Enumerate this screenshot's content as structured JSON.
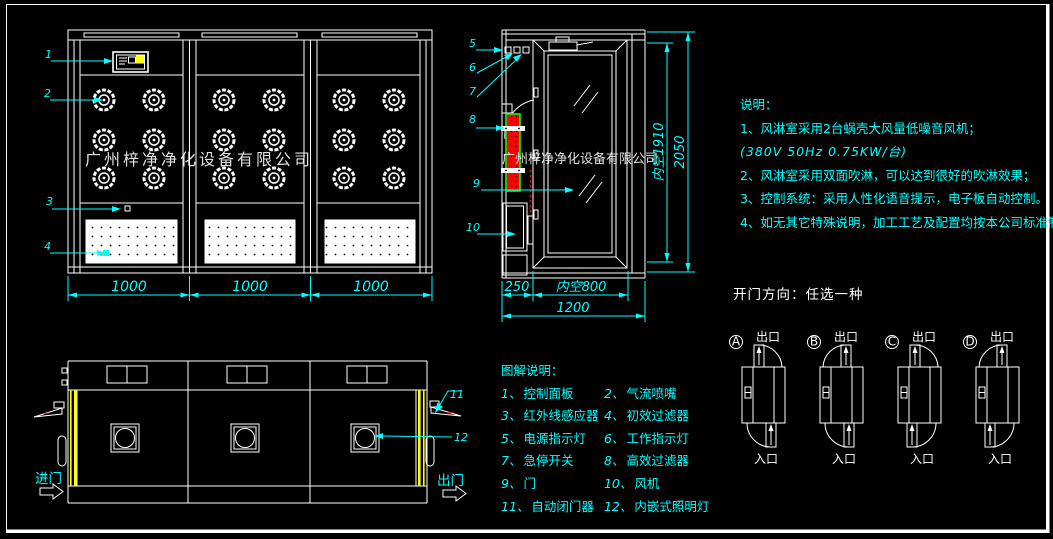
{
  "colors": {
    "background": "#000000",
    "line": "#ffffff",
    "annotation": "#00ffff",
    "door_highlight": "#ffff00",
    "hepa_filter_fill": "#ff0000",
    "hepa_filter_border": "#00ff00",
    "panel_button": "#ffff00"
  },
  "watermark": {
    "company": "广州梓净净化设备有限公司"
  },
  "front_view": {
    "callouts": {
      "control_panel": "1",
      "nozzle": "2",
      "ir_sensor": "3",
      "pre_filter": "4"
    },
    "width_dims": [
      "1000",
      "1000",
      "1000"
    ]
  },
  "side_view": {
    "callouts": {
      "power_light": "5",
      "work_light": "6",
      "estop": "7",
      "hepa": "8",
      "door": "9",
      "fan": "10"
    },
    "bottom_dims": {
      "left": "250",
      "opening": "内空800",
      "total": "1200"
    },
    "height_dims": {
      "inner": "内空1910",
      "total": "2050"
    }
  },
  "plan_view": {
    "callouts": {
      "door_closer": "11",
      "light": "12"
    },
    "entry_label": "进门",
    "exit_label": "出门"
  },
  "notes": {
    "title": "说明：",
    "line1": "1、风淋室采用2台蜗壳大风量低噪音风机；",
    "line2": "(380V  50Hz  0.75KW/台)",
    "line3": "2、风淋室采用双面吹淋，可以达到很好的吹淋效果；",
    "line4": "3、控制系统：采用人性化语音提示，电子板自动控制。",
    "line5": "4、如无其它特殊说明，加工工艺及配置均按本公司标准制作。"
  },
  "legend": {
    "title": "图解说明：",
    "items": [
      {
        "num": "1、",
        "label": "控制面板"
      },
      {
        "num": "2、",
        "label": "气流喷嘴"
      },
      {
        "num": "3、",
        "label": "红外线感应器"
      },
      {
        "num": "4、",
        "label": "初效过滤器"
      },
      {
        "num": "5、",
        "label": "电源指示灯"
      },
      {
        "num": "6、",
        "label": "工作指示灯"
      },
      {
        "num": "7、",
        "label": "急停开关"
      },
      {
        "num": "8、",
        "label": "高效过滤器"
      },
      {
        "num": "9、",
        "label": "门"
      },
      {
        "num": "10、",
        "label": "风机"
      },
      {
        "num": "11、",
        "label": "自动闭门器"
      },
      {
        "num": "12、",
        "label": "内嵌式照明灯"
      }
    ]
  },
  "door_options": {
    "title": "开门方向：任选一种",
    "exit_label": "出口",
    "entry_label": "入口",
    "options": [
      {
        "letter": "A"
      },
      {
        "letter": "B"
      },
      {
        "letter": "C"
      },
      {
        "letter": "D"
      }
    ]
  }
}
